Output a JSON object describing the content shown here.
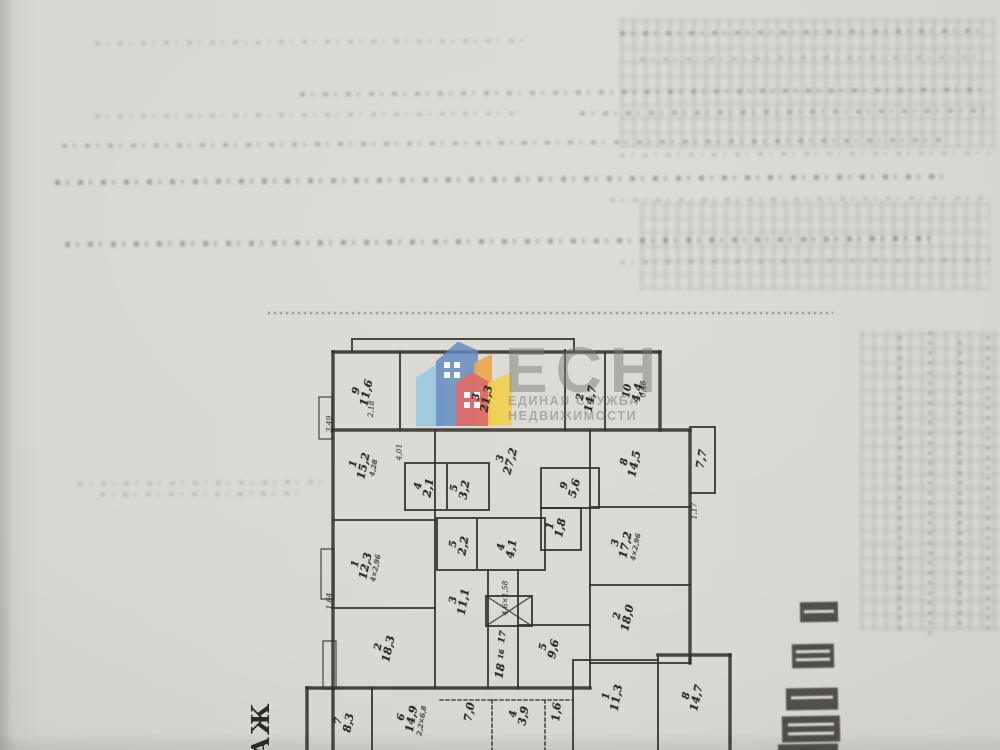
{
  "watermark": {
    "abbr": "ЕСН",
    "tagline1": "ЕДИНАЯ СЛУЖБА",
    "tagline2": "НЕДВИЖИМОСТИ",
    "brand_colors": {
      "blue": "#6288c2",
      "light_blue": "#8cc7e2",
      "red": "#dd615e",
      "orange": "#efa23b",
      "yellow": "#f2cf40"
    },
    "text_color": "#7c7b77"
  },
  "floorplan": {
    "floor_text_fragment": "АЖ",
    "ink_color": "#34322c",
    "rooms": [
      {
        "n": "9",
        "a": "11,6",
        "x": 362,
        "y": 392,
        "r": -78
      },
      {
        "n": "3",
        "a": "21,3",
        "x": 482,
        "y": 398,
        "r": -80
      },
      {
        "n": "2",
        "a": "14,7",
        "x": 586,
        "y": 398,
        "r": -80
      },
      {
        "n": "10",
        "a": "4,4",
        "x": 633,
        "y": 392,
        "r": -80
      },
      {
        "n": "1",
        "a": "15,2",
        "d": "4,28",
        "x": 364,
        "y": 466,
        "r": -78
      },
      {
        "n": "3",
        "a": "27,2",
        "x": 506,
        "y": 460,
        "r": -75
      },
      {
        "n": "4",
        "a": "2,1",
        "x": 424,
        "y": 487,
        "r": -80
      },
      {
        "n": "5",
        "a": "3,2",
        "x": 460,
        "y": 489,
        "r": -80
      },
      {
        "n": "9",
        "a": "5,6",
        "x": 570,
        "y": 487,
        "r": -75
      },
      {
        "n": "8",
        "a": "14,5",
        "x": 630,
        "y": 463,
        "r": -78
      },
      {
        "n": "",
        "a": "7,7",
        "x": 702,
        "y": 459,
        "r": -80
      },
      {
        "n": "1",
        "a": "1,8",
        "x": 556,
        "y": 527,
        "r": -78
      },
      {
        "n": "1",
        "a": "12,3",
        "d": "4×2,96",
        "x": 366,
        "y": 566,
        "r": -78
      },
      {
        "n": "5",
        "a": "2,2",
        "x": 459,
        "y": 545,
        "r": -80
      },
      {
        "n": "4",
        "a": "4,1",
        "x": 507,
        "y": 548,
        "r": -80
      },
      {
        "n": "3",
        "a": "17,2",
        "d": "4×2,96",
        "x": 626,
        "y": 545,
        "r": -78
      },
      {
        "n": "3",
        "a": "11,1",
        "x": 459,
        "y": 601,
        "r": -80
      },
      {
        "n": "2",
        "a": "18,3",
        "x": 384,
        "y": 648,
        "r": -78
      },
      {
        "n": "2",
        "a": "18,0",
        "x": 623,
        "y": 617,
        "r": -78
      },
      {
        "n": "5",
        "a": "9,6",
        "x": 549,
        "y": 648,
        "r": -78
      },
      {
        "n": "",
        "a": "7,0",
        "x": 470,
        "y": 712,
        "r": -80
      },
      {
        "n": "4",
        "a": "3,9",
        "x": 519,
        "y": 715,
        "r": -80
      },
      {
        "n": "",
        "a": "1,6",
        "x": 557,
        "y": 712,
        "r": -85
      },
      {
        "n": "1",
        "a": "11,3",
        "x": 612,
        "y": 697,
        "r": -80
      },
      {
        "n": "8",
        "a": "14,7",
        "x": 692,
        "y": 697,
        "r": -78
      },
      {
        "n": "7",
        "a": "8,3",
        "x": 344,
        "y": 722,
        "r": -80
      },
      {
        "n": "6",
        "a": "14,9",
        "d": "2,2×6,8",
        "x": 412,
        "y": 719,
        "r": -80
      }
    ],
    "dims": [
      {
        "t": "2,18",
        "x": 371,
        "y": 409,
        "r": -85
      },
      {
        "t": "3,49",
        "x": 329,
        "y": 424,
        "r": -90
      },
      {
        "t": "4,01",
        "x": 399,
        "y": 452,
        "r": -90
      },
      {
        "t": "0,48",
        "x": 643,
        "y": 389,
        "r": -90
      },
      {
        "t": "4,6×1,58",
        "x": 505,
        "y": 598,
        "r": -90
      },
      {
        "t": "1,17",
        "x": 694,
        "y": 511,
        "r": -90
      },
      {
        "t": "1,64",
        "x": 329,
        "y": 601,
        "r": -90
      }
    ],
    "stair_numbers": [
      {
        "t": "17",
        "x": 503,
        "y": 637,
        "r": -80,
        "fs": 9
      },
      {
        "t": "16",
        "x": 501,
        "y": 654,
        "r": -80,
        "fs": 7
      },
      {
        "t": "18",
        "x": 500,
        "y": 671,
        "r": -80,
        "fs": 11
      }
    ]
  }
}
